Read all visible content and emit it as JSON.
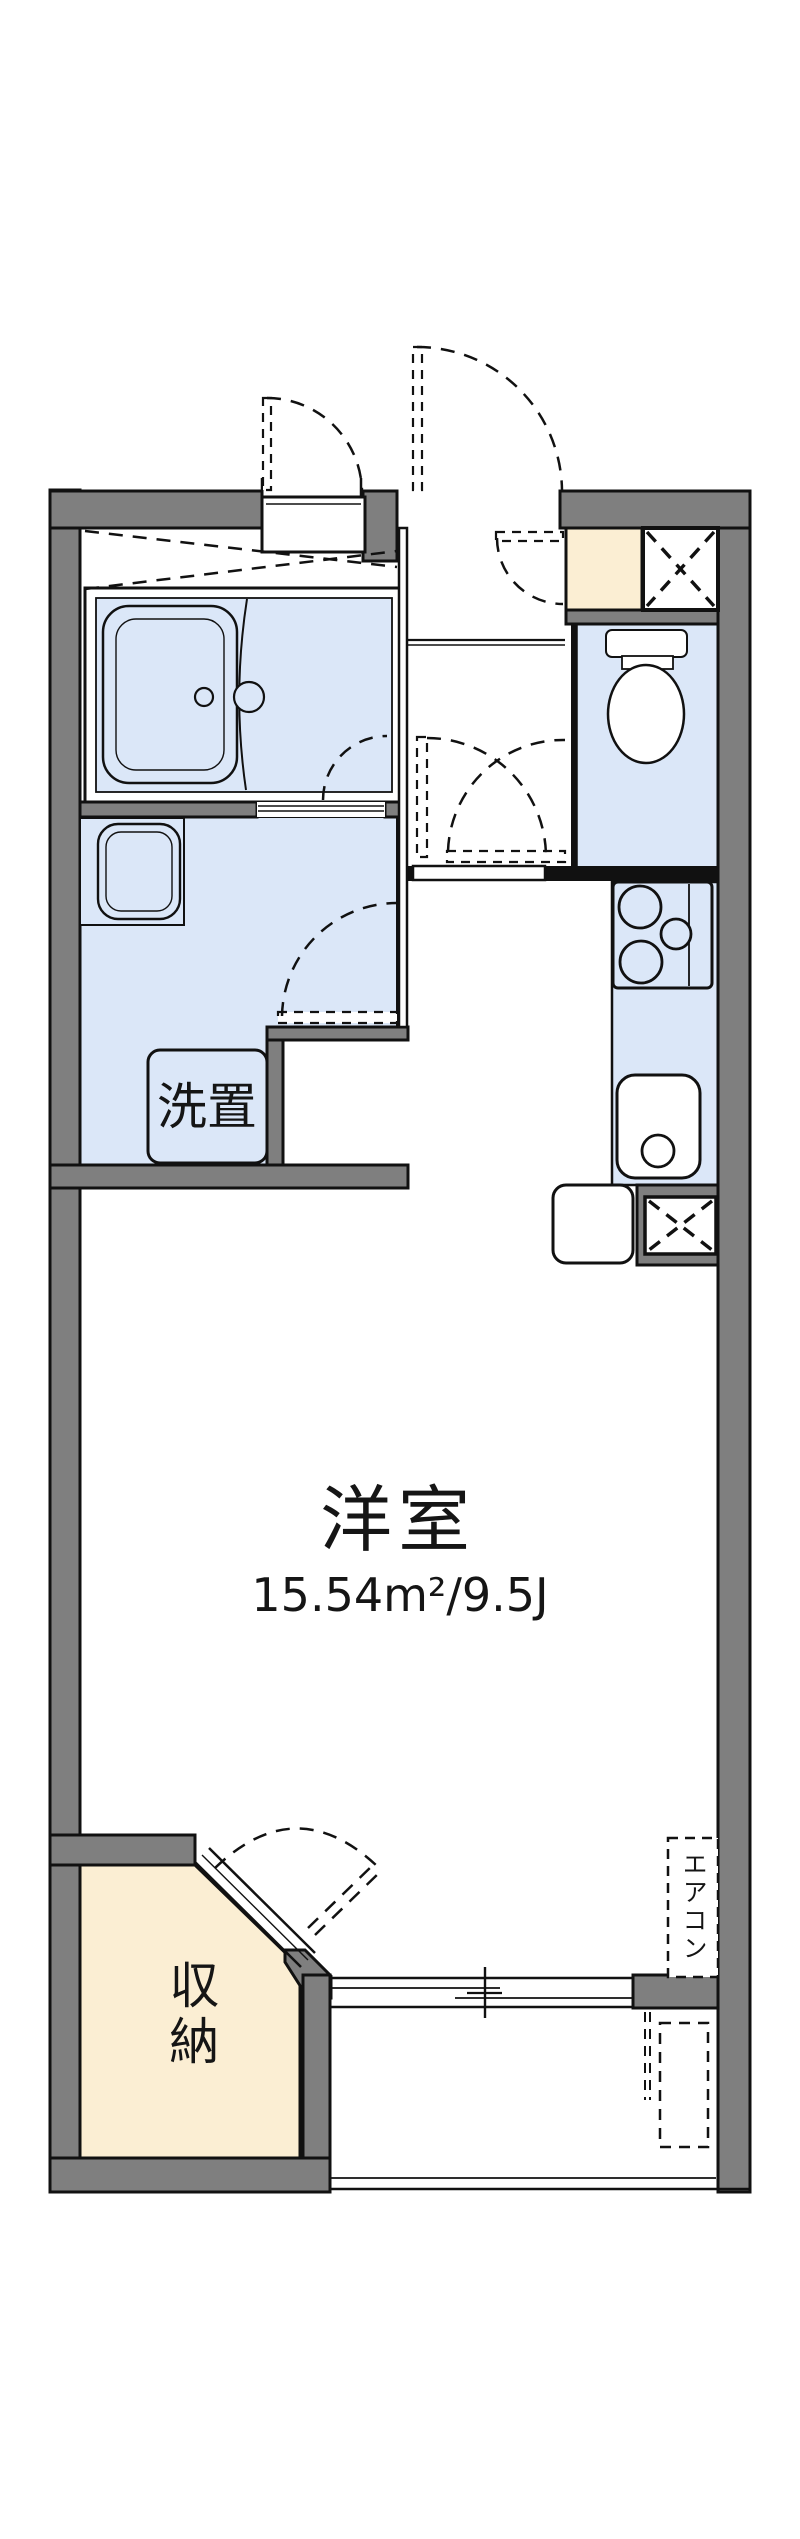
{
  "page": {
    "type": "apartment-floor-plan"
  },
  "labels": {
    "washer_place": "洗置",
    "main_room": "洋室",
    "main_room_area": "15.54m²/9.5J",
    "storage": "収納",
    "aircon": "エアコン"
  },
  "colors": {
    "wall": "#7f7f7f",
    "water": "#dbe7f8",
    "cream": "#fbeed3",
    "line": "#111111",
    "bg": "#ffffff"
  },
  "fixtures": [
    "bathtub",
    "shower-divider",
    "washbasin",
    "washing-machine-space",
    "toilet",
    "shoe-cabinet",
    "pipe-space-upper",
    "gas-stove",
    "kitchen-sink",
    "refrigerator-space",
    "pipe-space-lower",
    "air-conditioner-space",
    "storage-closet",
    "sliding-window",
    "balcony",
    "entrance-doors",
    "interior-doors"
  ]
}
